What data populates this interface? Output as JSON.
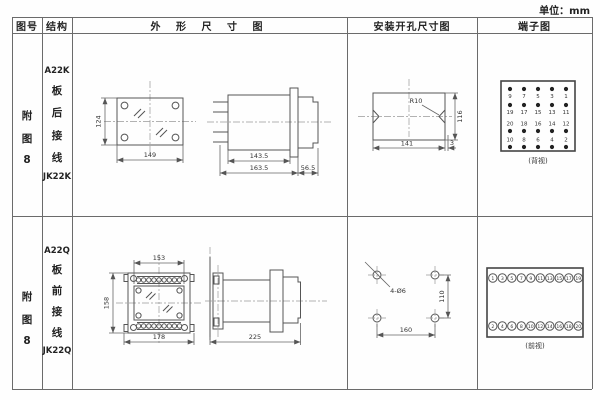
{
  "unit_label": "单位：mm",
  "headers": {
    "fig_no": "图号",
    "structure": "结构",
    "outline": "外 形 尺 寸 图",
    "mounting": "安装开孔尺寸图",
    "terminal": "端子图"
  },
  "rows": [
    {
      "fig_no": [
        "附",
        "图",
        "8"
      ],
      "structure_top": "A22K",
      "structure_chars": [
        "板",
        "后",
        "接",
        "线"
      ],
      "structure_bottom": "JK22K",
      "front": {
        "height": "124",
        "width": "149"
      },
      "side": {
        "depth_inner": "143.5",
        "depth_total": "163.5",
        "front_depth": "56.5"
      },
      "mounting": {
        "radius": "R10",
        "height": "116",
        "width": "141",
        "edge": "3"
      },
      "terminal": {
        "caption": "(背视)",
        "groups": [
          [
            "9",
            "7",
            "5",
            "3",
            "1"
          ],
          [
            "19",
            "17",
            "15",
            "13",
            "11"
          ],
          [
            "20",
            "18",
            "16",
            "14",
            "12"
          ],
          [
            "10",
            "8",
            "6",
            "4",
            "2"
          ]
        ]
      }
    },
    {
      "fig_no": [
        "附",
        "图",
        "8"
      ],
      "structure_top": "A22Q",
      "structure_chars": [
        "板",
        "前",
        "接",
        "线"
      ],
      "structure_bottom": "JK22Q",
      "front": {
        "inner_width": "153",
        "height": "158",
        "width": "178"
      },
      "side": {
        "depth": "225"
      },
      "mounting": {
        "holes": "4-Ø6",
        "height": "110",
        "width": "160"
      },
      "terminal": {
        "caption": "(前视)",
        "top": [
          "1",
          "3",
          "5",
          "7",
          "9",
          "11",
          "13",
          "15",
          "17",
          "19"
        ],
        "bottom": [
          "2",
          "4",
          "6",
          "8",
          "10",
          "12",
          "14",
          "16",
          "18",
          "20"
        ]
      }
    }
  ]
}
